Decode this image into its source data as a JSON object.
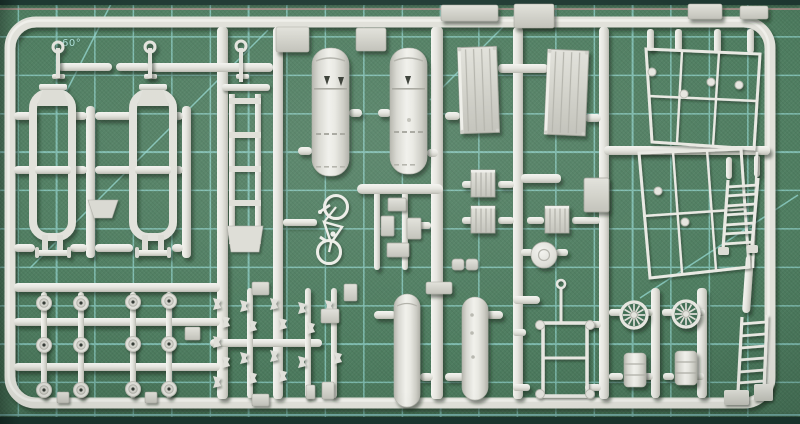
{
  "scene": {
    "type": "photograph",
    "subject": "injection-molded model kit sprue of light gray plastic parts lying on a green self-healing cutting mat"
  },
  "mat": {
    "label_60": "60°",
    "label_45": "45",
    "base_color": "#4e7d60",
    "grid_color": "#8fd2ca",
    "edge_color": "#1d3831",
    "ruler_pink_color": "#c79a9a",
    "label_color": "#aee0d8"
  },
  "sprue": {
    "plastic_color": "#e4e4de",
    "plastic_shadow_color": "#b7b7af",
    "parts": [
      {
        "name": "cylindrical-tank-frame",
        "qty": 2
      },
      {
        "name": "vent-pipe-with-ring",
        "qty": 3
      },
      {
        "name": "torpedo-spindle",
        "qty": 2
      },
      {
        "name": "mounting-bracket",
        "qty": 3
      },
      {
        "name": "ladder-chassis-frame",
        "qty": 1
      },
      {
        "name": "large-tank-half",
        "qty": 4
      },
      {
        "name": "bicycle",
        "qty": 1
      },
      {
        "name": "small-crate",
        "qty": 5
      },
      {
        "name": "ribbed-crate",
        "qty": 3
      },
      {
        "name": "dome-disc",
        "qty": 1
      },
      {
        "name": "plank-panel",
        "qty": 2
      },
      {
        "name": "flat-plate",
        "qty": 4
      },
      {
        "name": "wireframe-side-panel",
        "qty": 2
      },
      {
        "name": "ladder",
        "qty": 2
      },
      {
        "name": "spoked-wheel",
        "qty": 2
      },
      {
        "name": "small-drum",
        "qty": 2
      },
      {
        "name": "handcart-frame",
        "qty": 1
      },
      {
        "name": "road-wheel",
        "qty": 12
      },
      {
        "name": "detail-fitting",
        "qty": 18
      }
    ]
  }
}
